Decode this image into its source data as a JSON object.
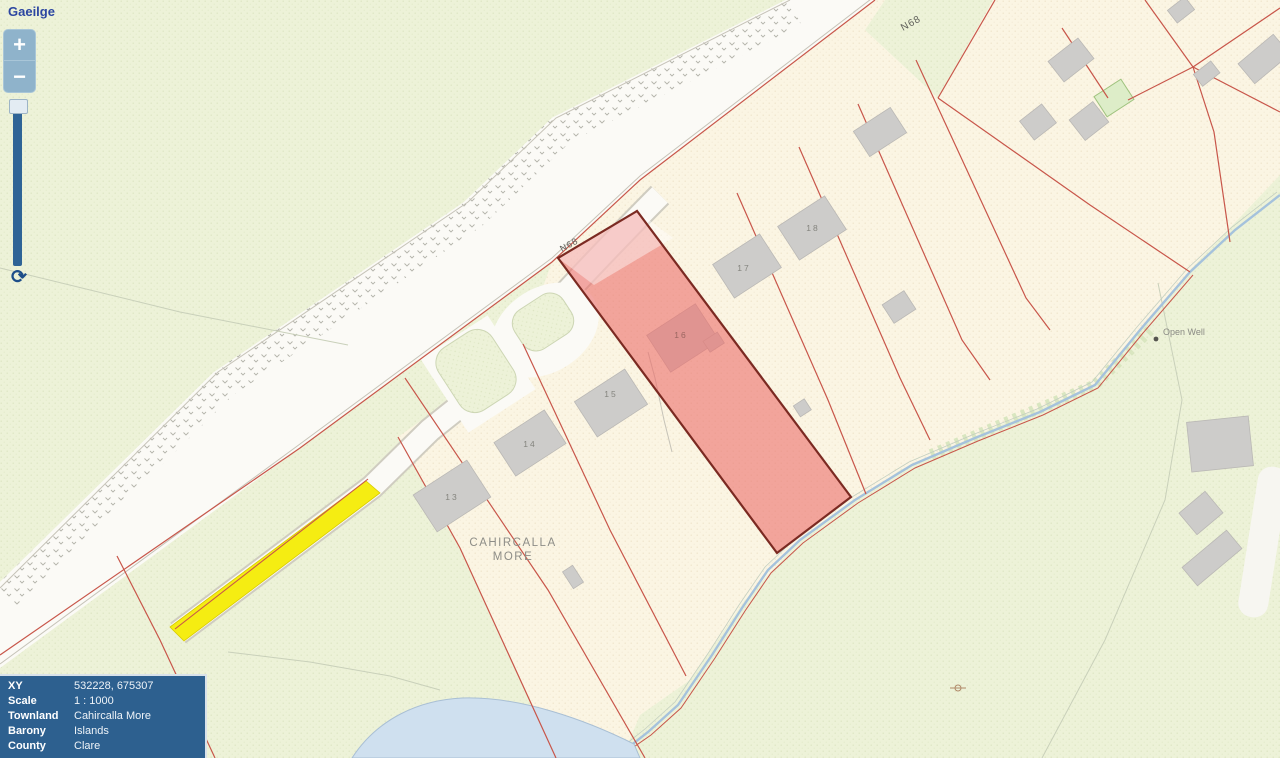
{
  "language_link": "Gaeilge",
  "controls": {
    "zoom_in_label": "+",
    "zoom_out_label": "−",
    "refresh_icon_glyph": "⟳"
  },
  "info_panel": {
    "rows": [
      {
        "label": "XY",
        "value": "532228, 675307"
      },
      {
        "label": "Scale",
        "value": "1 : 1000"
      },
      {
        "label": "Townland",
        "value": "Cahircalla More"
      },
      {
        "label": "Barony",
        "value": "Islands"
      },
      {
        "label": "County",
        "value": "Clare"
      }
    ]
  },
  "map_labels": {
    "road": "N68",
    "townland_line1": "CAHIRCALLA",
    "townland_line2": "MORE",
    "open_well": "Open Well",
    "house_numbers": [
      "13",
      "14",
      "15",
      "16",
      "17",
      "18"
    ]
  },
  "colors": {
    "highlight_parcel_fill": "#EC6E6B",
    "highlight_parcel_border": "#7B2A22",
    "highlight_laneway_yellow": "#F5ED12",
    "parcel_boundary_red": "#C8564A",
    "water_blue": "#A5C2DC",
    "panel_background": "#2D608F",
    "link_blue": "#2C46A1",
    "field_green": "#EDF2D8",
    "parcel_cream": "#FBF5E3",
    "building_grey": "#CDCCCA"
  }
}
